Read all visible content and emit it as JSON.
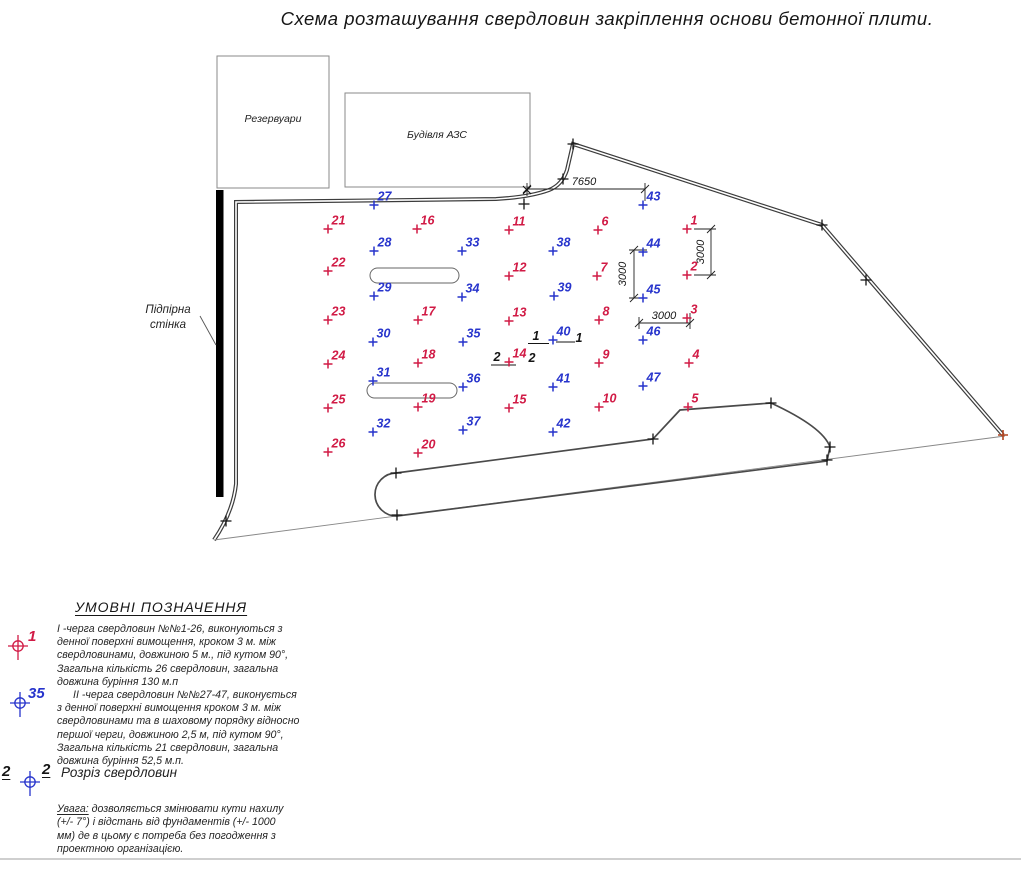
{
  "title": "Схема розташування свердловин закріплення основи бетонної плити.",
  "site": {
    "reservoir_label": "Резервуари",
    "azs_label": "Будівля АЗС",
    "wall_label_line1": "Підпірна",
    "wall_label_line2": "стінка"
  },
  "dimensions": {
    "top": "7650",
    "v_left": "3000",
    "v_right": "3000",
    "h_bottom": "3000"
  },
  "sections": {
    "s1_left": "1",
    "s1_right": "1",
    "s2_left": "2",
    "s2_right": "2"
  },
  "colors": {
    "stage1": "#d11a45",
    "stage2": "#2734cc",
    "marker": "#151515",
    "end_marker": "#b2441f"
  },
  "points": {
    "stage1": [
      {
        "n": "1",
        "x": 687,
        "y": 229
      },
      {
        "n": "2",
        "x": 687,
        "y": 275
      },
      {
        "n": "3",
        "x": 687,
        "y": 318
      },
      {
        "n": "4",
        "x": 689,
        "y": 363
      },
      {
        "n": "5",
        "x": 688,
        "y": 407
      },
      {
        "n": "6",
        "x": 598,
        "y": 230
      },
      {
        "n": "7",
        "x": 597,
        "y": 276
      },
      {
        "n": "8",
        "x": 599,
        "y": 320
      },
      {
        "n": "9",
        "x": 599,
        "y": 363
      },
      {
        "n": "10",
        "x": 599,
        "y": 407
      },
      {
        "n": "11",
        "x": 509,
        "y": 230
      },
      {
        "n": "12",
        "x": 509,
        "y": 276
      },
      {
        "n": "13",
        "x": 509,
        "y": 321
      },
      {
        "n": "14",
        "x": 509,
        "y": 362
      },
      {
        "n": "15",
        "x": 509,
        "y": 408
      },
      {
        "n": "16",
        "x": 417,
        "y": 229
      },
      {
        "n": "17",
        "x": 418,
        "y": 320
      },
      {
        "n": "18",
        "x": 418,
        "y": 363
      },
      {
        "n": "19",
        "x": 418,
        "y": 407
      },
      {
        "n": "20",
        "x": 418,
        "y": 453
      },
      {
        "n": "21",
        "x": 328,
        "y": 229
      },
      {
        "n": "22",
        "x": 328,
        "y": 271
      },
      {
        "n": "23",
        "x": 328,
        "y": 320
      },
      {
        "n": "24",
        "x": 328,
        "y": 364
      },
      {
        "n": "25",
        "x": 328,
        "y": 408
      },
      {
        "n": "26",
        "x": 328,
        "y": 452
      }
    ],
    "stage2": [
      {
        "n": "27",
        "x": 374,
        "y": 205
      },
      {
        "n": "28",
        "x": 374,
        "y": 251
      },
      {
        "n": "29",
        "x": 374,
        "y": 296
      },
      {
        "n": "30",
        "x": 373,
        "y": 342
      },
      {
        "n": "31",
        "x": 373,
        "y": 381
      },
      {
        "n": "32",
        "x": 373,
        "y": 432
      },
      {
        "n": "33",
        "x": 462,
        "y": 251
      },
      {
        "n": "34",
        "x": 462,
        "y": 297
      },
      {
        "n": "35",
        "x": 463,
        "y": 342
      },
      {
        "n": "36",
        "x": 463,
        "y": 387
      },
      {
        "n": "37",
        "x": 463,
        "y": 430
      },
      {
        "n": "38",
        "x": 553,
        "y": 251
      },
      {
        "n": "39",
        "x": 554,
        "y": 296
      },
      {
        "n": "40",
        "x": 553,
        "y": 340
      },
      {
        "n": "41",
        "x": 553,
        "y": 387
      },
      {
        "n": "42",
        "x": 553,
        "y": 432
      },
      {
        "n": "43",
        "x": 643,
        "y": 205
      },
      {
        "n": "44",
        "x": 643,
        "y": 252
      },
      {
        "n": "45",
        "x": 643,
        "y": 298
      },
      {
        "n": "46",
        "x": 643,
        "y": 340
      },
      {
        "n": "47",
        "x": 643,
        "y": 386
      }
    ]
  },
  "markers": {
    "plus": [
      [
        524,
        204
      ],
      [
        563,
        179
      ],
      [
        573,
        144
      ],
      [
        822,
        225
      ],
      [
        866,
        280
      ],
      [
        226,
        521
      ],
      [
        396,
        473
      ],
      [
        397,
        515
      ],
      [
        653,
        439
      ],
      [
        771,
        403
      ],
      [
        830,
        447
      ],
      [
        827,
        460
      ]
    ],
    "x": [
      [
        527,
        190
      ]
    ],
    "end": [
      1003,
      435
    ]
  },
  "legend": {
    "header": "УМОВНІ ПОЗНАЧЕННЯ",
    "item1": {
      "symbol_label": "1",
      "text": "І -черга свердловин №№1-26, виконуються з\nденної поверхні вимощення, кроком 3 м. між\nсвердловинами, довжиною 5 м., під кутом 90°,\nЗагальна кількість 26 свердловин, загальна\nдовжина буріння 130 м.п"
    },
    "item2": {
      "symbol_label": "35",
      "text": "ІІ -черга свердловин №№27-47, виконується\nз денної поверхні вимощення кроком 3 м. між\nсвердловинами та в шаховому порядку відносно\nпершої черги, довжиною 2,5 м, під кутом 90°,\nЗагальна кількість 21 свердловин, загальна\nдовжина буріння 52,5 м.п."
    },
    "item3": {
      "left": "2",
      "right": "2",
      "text": "Розріз свердловин"
    },
    "note_label": "Увага:",
    "note_text": " дозволяється змінювати кути нахилу\n(+/- 7°)  і відстань від фундаментів (+/- 1000\nмм) де в цьому є потреба без погодження з\nпроектною організацією."
  }
}
